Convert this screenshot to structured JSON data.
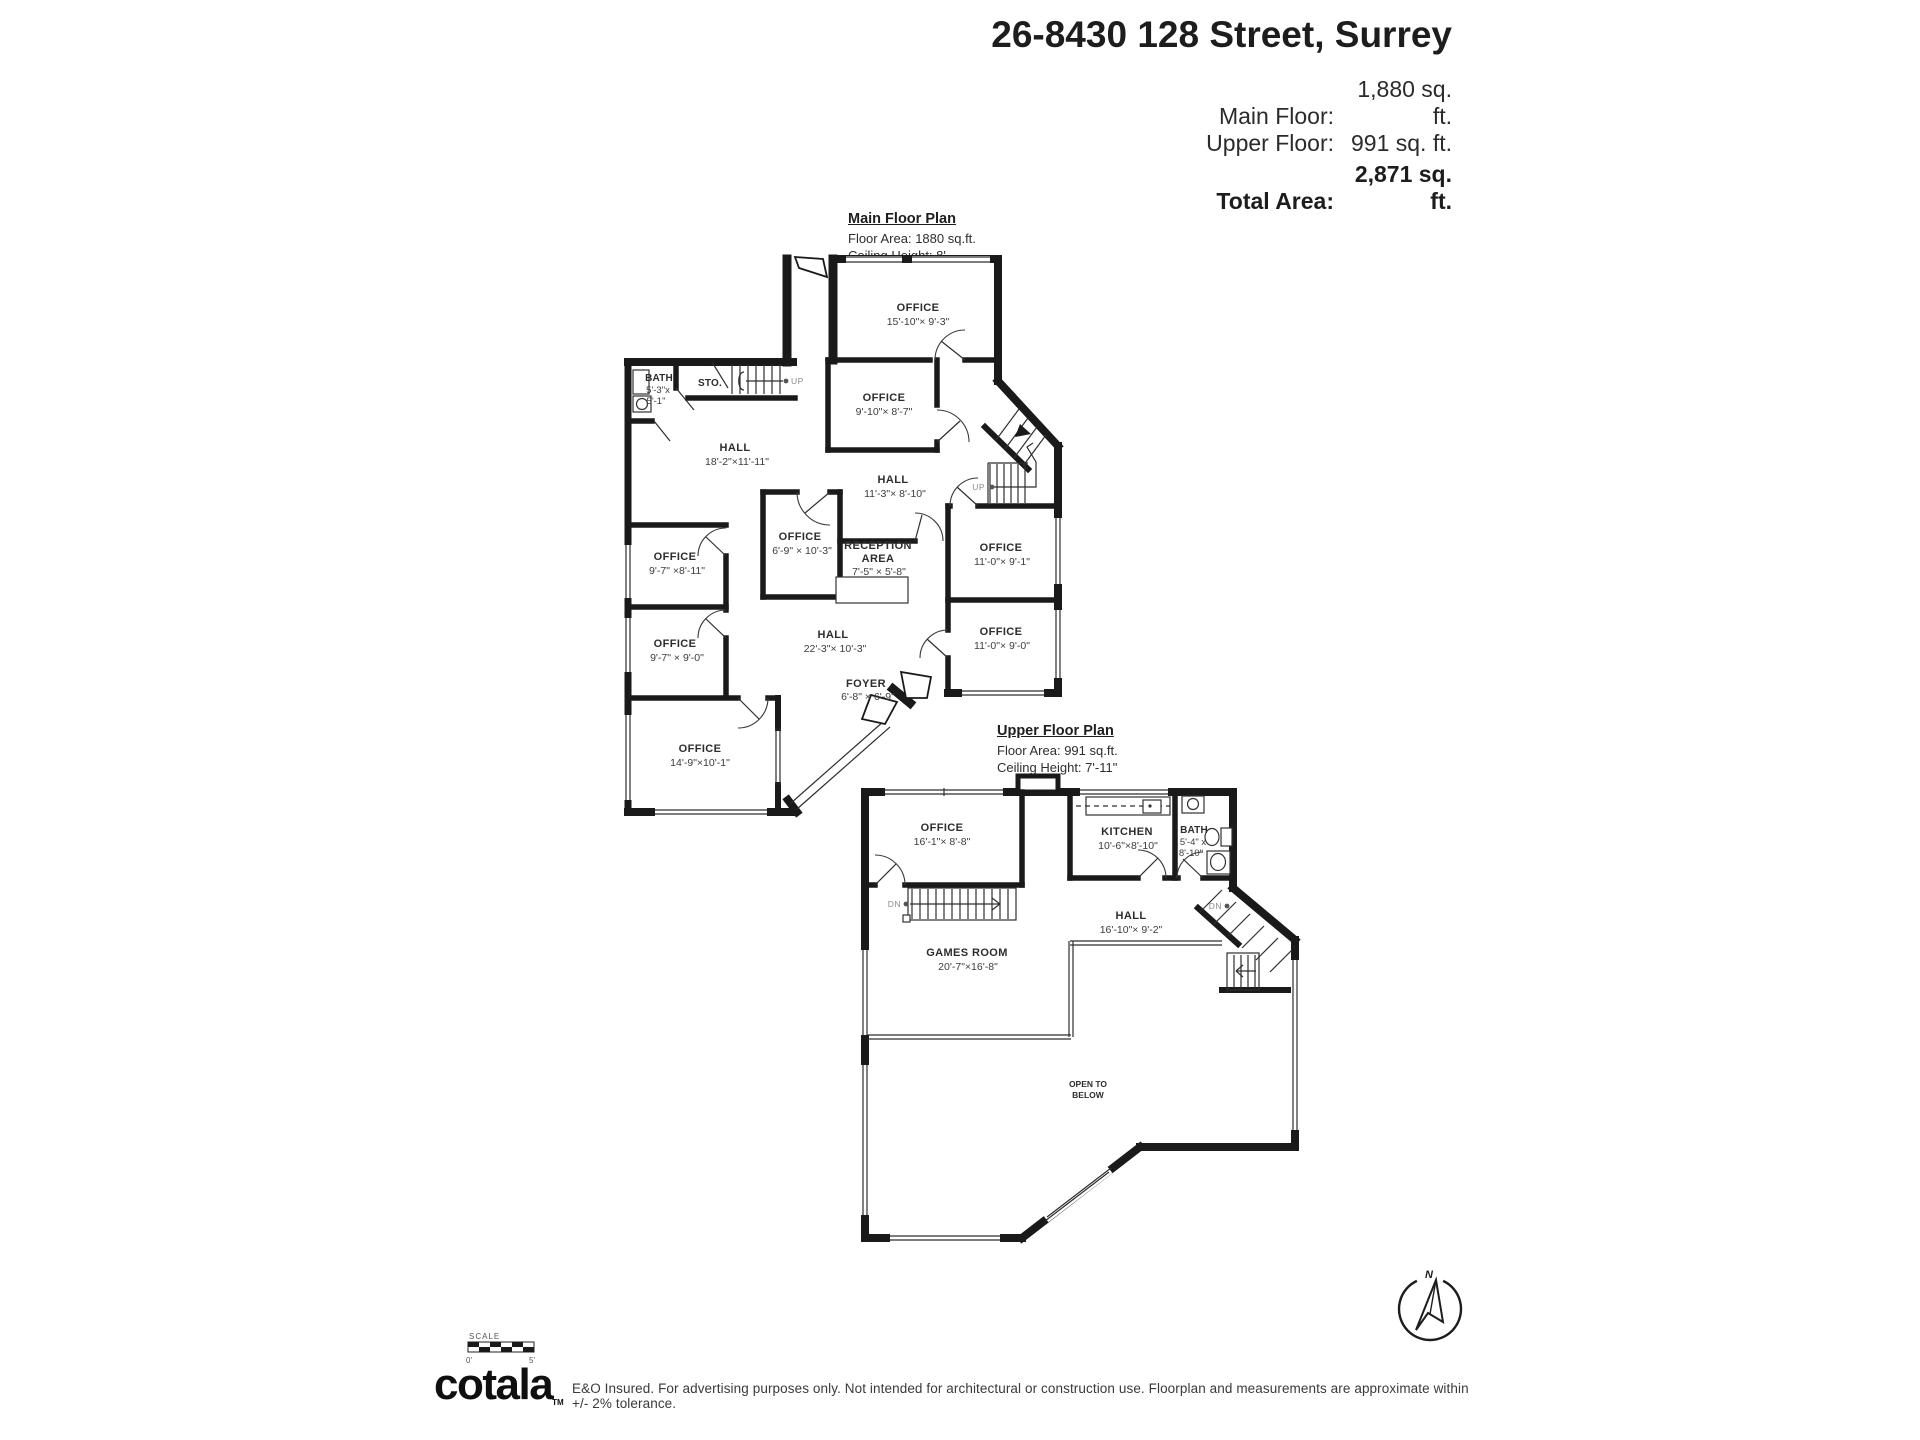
{
  "header": {
    "title": "26-8430 128 Street, Surrey",
    "rows": [
      {
        "label": "Main Floor:",
        "value": "1,880 sq. ft."
      },
      {
        "label": "Upper Floor:",
        "value": "991 sq. ft."
      }
    ],
    "total": {
      "label": "Total Area:",
      "value": "2,871 sq. ft."
    }
  },
  "main_floor": {
    "heading": "Main Floor Plan",
    "floor_area": "Floor Area: 1880 sq.ft.",
    "ceiling": "Ceiling Height: 8'",
    "rooms": [
      {
        "name": "OFFICE",
        "dims": "15'-10\"× 9'-3\""
      },
      {
        "name": "OFFICE",
        "dims": "9'-10\"× 8'-7\""
      },
      {
        "name": "BATH",
        "dims": "5'-3\"x",
        "dims2": "5'-1\""
      },
      {
        "name": "STO."
      },
      {
        "name": "HALL",
        "dims": "18'-2\"×11'-11\""
      },
      {
        "name": "HALL",
        "dims": "11'-3\"× 8'-10\""
      },
      {
        "name": "OFFICE",
        "dims": "6'-9\" × 10'-3\""
      },
      {
        "name": "RECEPTION",
        "name2": "AREA",
        "dims": "7'-5\" × 5'-8\""
      },
      {
        "name": "OFFICE",
        "dims": "11'-0\"× 9'-1\""
      },
      {
        "name": "OFFICE",
        "dims": "9'-7\" ×8'-11\""
      },
      {
        "name": "OFFICE",
        "dims": "9'-7\" × 9'-0\""
      },
      {
        "name": "HALL",
        "dims": "22'-3\"× 10'-3\""
      },
      {
        "name": "OFFICE",
        "dims": "11'-0\"× 9'-0\""
      },
      {
        "name": "FOYER",
        "dims": "6'-8\" × 6'-9\""
      },
      {
        "name": "OFFICE",
        "dims": "14'-9\"×10'-1\""
      }
    ],
    "stairs": {
      "up_left": "UP",
      "up_right": "UP"
    }
  },
  "upper_floor": {
    "heading": "Upper Floor Plan",
    "floor_area": "Floor Area: 991 sq.ft.",
    "ceiling": "Ceiling Height: 7'-11\"",
    "rooms": [
      {
        "name": "OFFICE",
        "dims": "16'-1\"× 8'-8\""
      },
      {
        "name": "KITCHEN",
        "dims": "10'-6\"×8'-10\""
      },
      {
        "name": "BATH",
        "dims": "5'-4\" x",
        "dims2": "8'-10\""
      },
      {
        "name": "HALL",
        "dims": "16'-10\"× 9'-2\""
      },
      {
        "name": "GAMES ROOM",
        "dims": "20'-7\"×16'-8\""
      },
      {
        "name": "OPEN TO",
        "name2": "BELOW"
      }
    ],
    "stairs": {
      "dn_left": "DN",
      "dn_right": "DN"
    }
  },
  "footer": {
    "scale_label": "SCALE",
    "scale_zero": "0'",
    "scale_five": "5'",
    "logo_text": "cotala",
    "logo_tm": "TM",
    "disclaimer": "E&O Insured. For advertising purposes only. Not intended for architectural or construction use. Floorplan and measurements are approximate within +/- 2% tolerance.",
    "compass_n": "N"
  }
}
